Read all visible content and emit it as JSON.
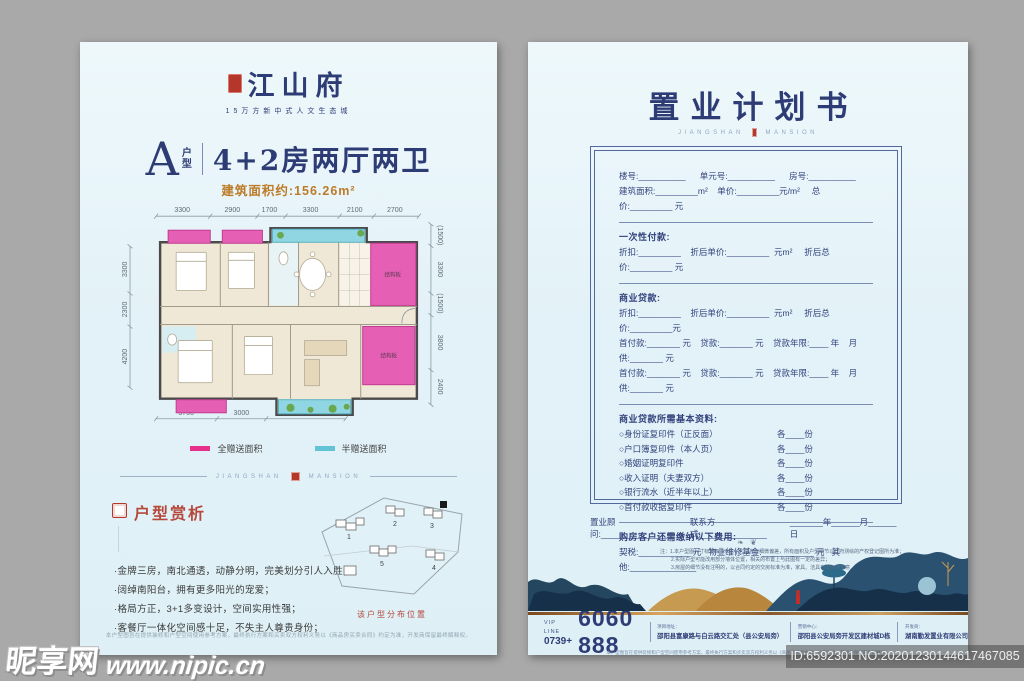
{
  "left_page": {
    "logo": {
      "name": "江山府",
      "tagline": "15万方新中式人文生态城"
    },
    "title": {
      "type_letter": "A",
      "type_char1": "户",
      "type_char2": "型",
      "headline": "4+2房两厅两卫",
      "area_line": "建筑面积约:156.26m²"
    },
    "floorplan": {
      "dims_top": [
        "3300",
        "2900",
        "1700",
        "3300",
        "2100",
        "2700"
      ],
      "dims_left": [
        "3300",
        "2300",
        "4200"
      ],
      "dims_right": [
        "(1500)",
        "3300",
        "(1500)",
        "3800",
        "2400"
      ],
      "dims_bottom": [
        "3700",
        "3000",
        "4800"
      ],
      "slab_label": "结构板",
      "legend": [
        {
          "label": "全赠送面积",
          "color": "#e6308c"
        },
        {
          "label": "半赠送面积",
          "color": "#62c3d5"
        }
      ]
    },
    "brand_divider": {
      "left": "JIANGSHAN",
      "right": "MANSION"
    },
    "analysis": {
      "title": "户型赏析",
      "bullets": [
        "·金牌三房，南北通透，动静分明，完美划分引人入胜；",
        "·阔绰南阳台，拥有更多阳光的宠爱；",
        "·格局方正，3+1多变设计，空间实用性强；",
        "·客餐厅一体化空间感十足，不失主人尊贵身份；"
      ]
    },
    "siteplan": {
      "caption": "该户型分布位置",
      "buildings": [
        "1",
        "2",
        "3",
        "4",
        "5"
      ]
    },
    "disclaimer": "本户型图旨在提供装修和户型空间使用参考方案，最终执行方案和买卖双方权利义务以《商品房买卖合同》约定为准，开发商保留最终解释权。"
  },
  "right_page": {
    "title": "置业计划书",
    "brand_divider": {
      "left": "JIANGSHAN",
      "right": "MANSION"
    },
    "form": {
      "unit_row": "楼号:__________      单元号:__________      房号:__________",
      "area_row": "建筑面积:_________m²    单价:_________元/m²     总价:_________ 元",
      "onetime_title": "一次性付款:",
      "onetime_row": "折扣:_________    折后单价:_________  元m²     折后总价:_________ 元",
      "loan_title": "商业贷款:",
      "loan_row1": "折扣:_________    折后单价:_________  元m²     折后总价:_________元",
      "loan_row2": "首付款:_______ 元    贷款:_______ 元    贷款年限:____ 年    月供:_______ 元",
      "loan_row3": "首付款:_______ 元    贷款:_______ 元    贷款年限:____ 年    月供:_______ 元",
      "docs_title": "商业贷款所需基本资料:",
      "docs": [
        {
          "name": "○身份证复印件（正反面）",
          "count": "各____份"
        },
        {
          "name": "○户口簿复印件（本人页）",
          "count": "各____份"
        },
        {
          "name": "○婚姻证明复印件",
          "count": "各____份"
        },
        {
          "name": "○收入证明（夫妻双方）",
          "count": "各____份"
        },
        {
          "name": "○银行流水（近半年以上）",
          "count": "各____份"
        },
        {
          "name": "○首付款收据复印件",
          "count": "各____份"
        }
      ],
      "fees_title": "购房客户还需缴纳以下费用:",
      "fees_row": "契税:___________ 元   物业维修基金:___________ 元   其他:______________"
    },
    "advisor": {
      "advisor": "置业顾问:______________",
      "contact": "联系方式:______________",
      "date": "_______年______月______日"
    },
    "notes": [
      "注：1.本户型图尺寸标准仅供示意，可能存在细微偏差，所有面积及户型细节以政府测绘的产权登记图所为准；",
      "2.实际户型可能改用部分墙体位置，相关的布置上与此图有一定的差异；",
      "3.房屋的细节没有注明的，以合同约定的交房标准为准，家具、洁具布置仅供示意"
    ],
    "footer": {
      "vip_label": "VIP LINE",
      "vip_prefix": "0739+",
      "phone": "6060 888",
      "cols": [
        {
          "label": "项目地址：",
          "value": "邵阳县富康路与白云路交汇处（县公安局旁）"
        },
        {
          "label": "营销中心：",
          "value": "邵阳县公安局旁开发区建材城D栋"
        },
        {
          "label": "开发商：",
          "value": "湖南勤发置业有限公司"
        }
      ]
    },
    "footer_note": "本户型图旨在提供装修和户型空间使用参考方案，最终执行方案和买卖双方权利义务以《商品房买卖合同》约定为准，开发商保留最终解释权。"
  },
  "watermark": {
    "site_name": "昵享网",
    "site_url": "www.nipic.cn",
    "id_line": "ID:6592301 NO:20201230144617467085"
  },
  "flourish": "❧ ❦"
}
